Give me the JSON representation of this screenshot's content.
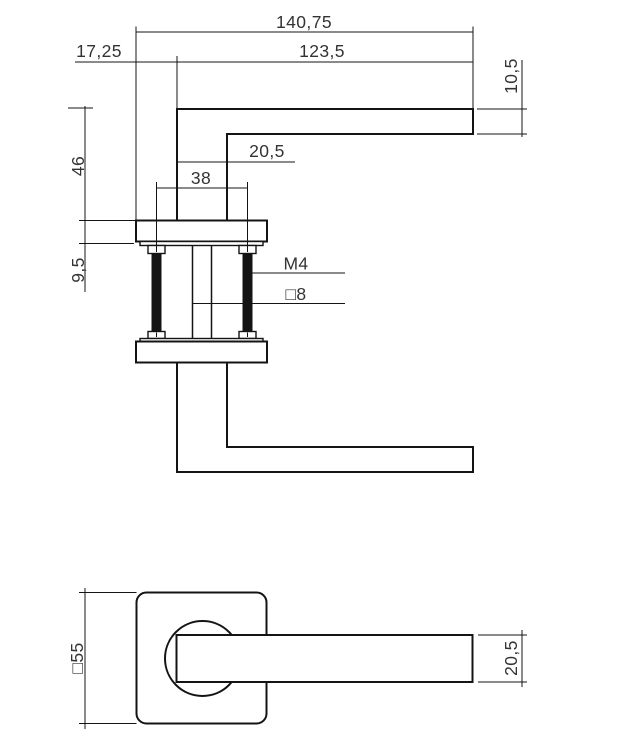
{
  "top_view": {
    "dim_total_length": "140,75",
    "dim_offset": "17,25",
    "dim_grip_length": "123,5",
    "dim_grip_thickness": "10,5",
    "dim_handle_height": "46",
    "dim_neck_width": "20,5",
    "dim_screw_spacing": "38",
    "dim_rosette_thickness": "9,5",
    "label_screw_thread": "M4",
    "label_spindle_size": "□8"
  },
  "front_view": {
    "dim_rosette_size": "□55",
    "dim_grip_thickness": "20,5"
  },
  "colors": {
    "line": "#141414",
    "text": "#333333",
    "background": "#ffffff"
  }
}
